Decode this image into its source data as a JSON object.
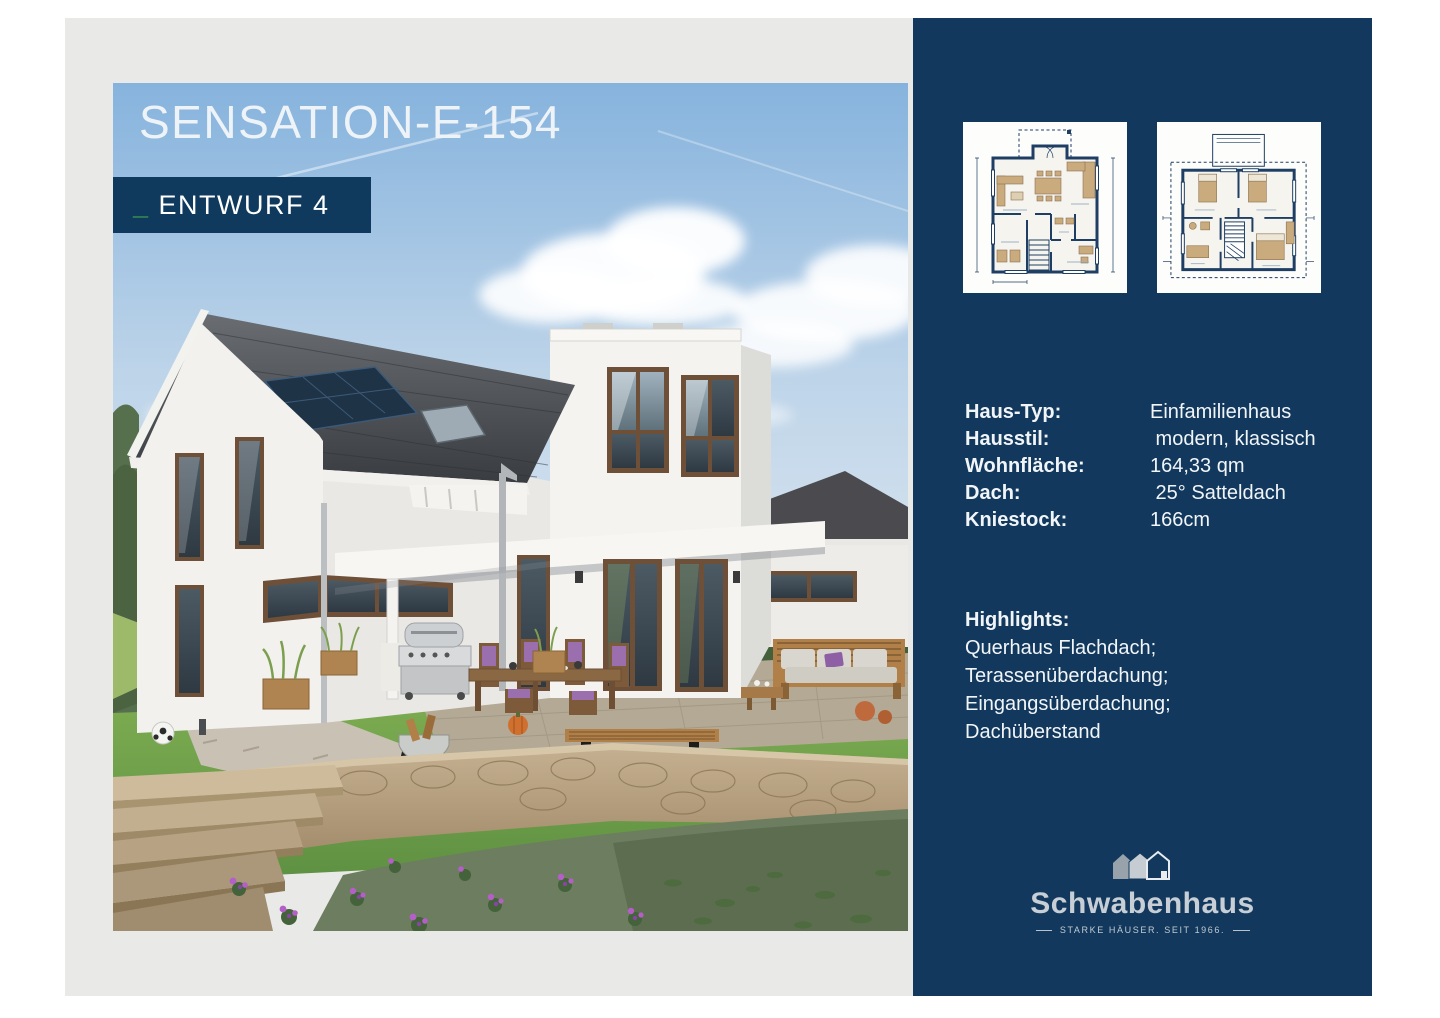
{
  "page": {
    "background": "#ffffff",
    "panel_gray": "#e9e9e7",
    "navy": "#12395d",
    "accent_green": "#46b24c"
  },
  "hero": {
    "title": "SENSATION-E-154",
    "badge_prefix": "_",
    "badge_label": "ENTWURF 4"
  },
  "sidebar": {
    "floorplans": [
      {
        "alt": "ground-floor-plan"
      },
      {
        "alt": "upper-floor-plan"
      }
    ],
    "specs": [
      {
        "label": "Haus-Typ:",
        "value": "Einfamilienhaus"
      },
      {
        "label": "Hausstil:",
        "value": " modern, klassisch"
      },
      {
        "label": "Wohnfläche:",
        "value": "164,33 qm"
      },
      {
        "label": "Dach:",
        "value": " 25° Satteldach"
      },
      {
        "label": "Kniestock:",
        "value": "166cm"
      }
    ],
    "highlights_title": "Highlights:",
    "highlights": [
      "Querhaus Flachdach;",
      "Terassenüberdachung;",
      "Eingangsüberdachung;",
      "Dachüberstand"
    ],
    "logo": {
      "wordmark": "Schwabenhaus",
      "tagline": "STARKE HÄUSER. SEIT 1966."
    }
  }
}
